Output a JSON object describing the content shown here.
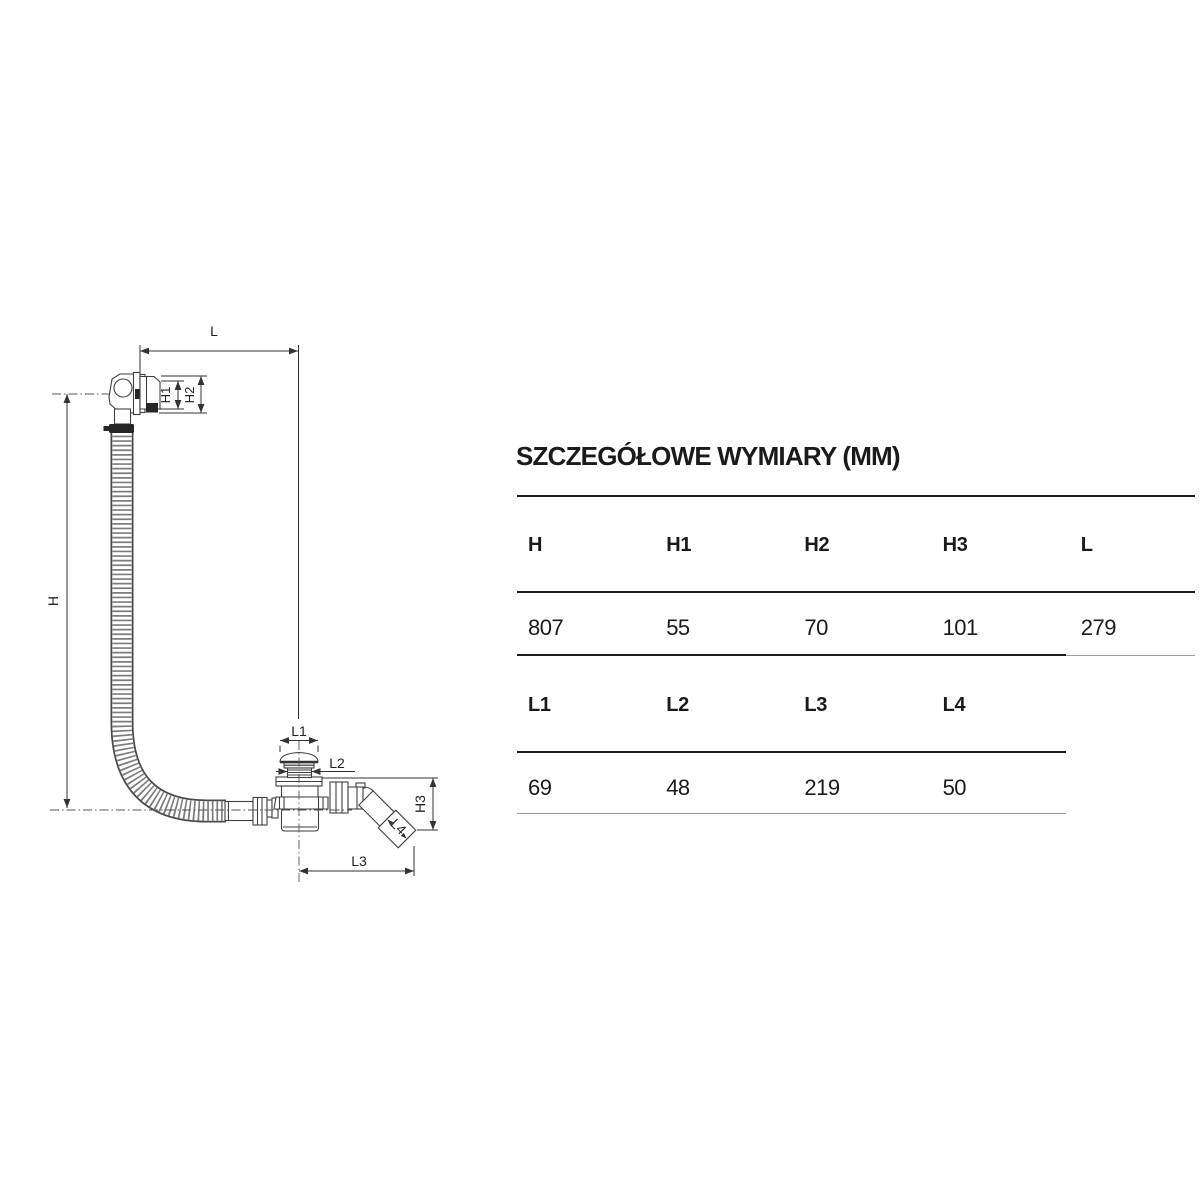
{
  "section_title": "SZCZEGÓŁOWE WYMIARY (MM)",
  "tables": [
    {
      "headers": [
        "H",
        "H1",
        "H2",
        "H3",
        "L"
      ],
      "values": [
        "807",
        "55",
        "70",
        "101",
        "279"
      ]
    },
    {
      "headers": [
        "L1",
        "L2",
        "L3",
        "L4"
      ],
      "values": [
        "69",
        "48",
        "219",
        "50"
      ]
    }
  ],
  "diagram": {
    "description": "technical drawing of bathtub drain with overflow hose",
    "labels": {
      "L": "L",
      "H": "H",
      "H1": "H1",
      "H2": "H2",
      "H3": "H3",
      "L1": "L1",
      "L2": "L2",
      "L3": "L3",
      "L4": "L4"
    }
  },
  "colors": {
    "drawing_line": "#3f3f3f",
    "dimension_line": "#333333",
    "rule_thick": "#1c1c1c",
    "rule_thin": "#9b9b9b",
    "text": "#1a1a1a"
  }
}
